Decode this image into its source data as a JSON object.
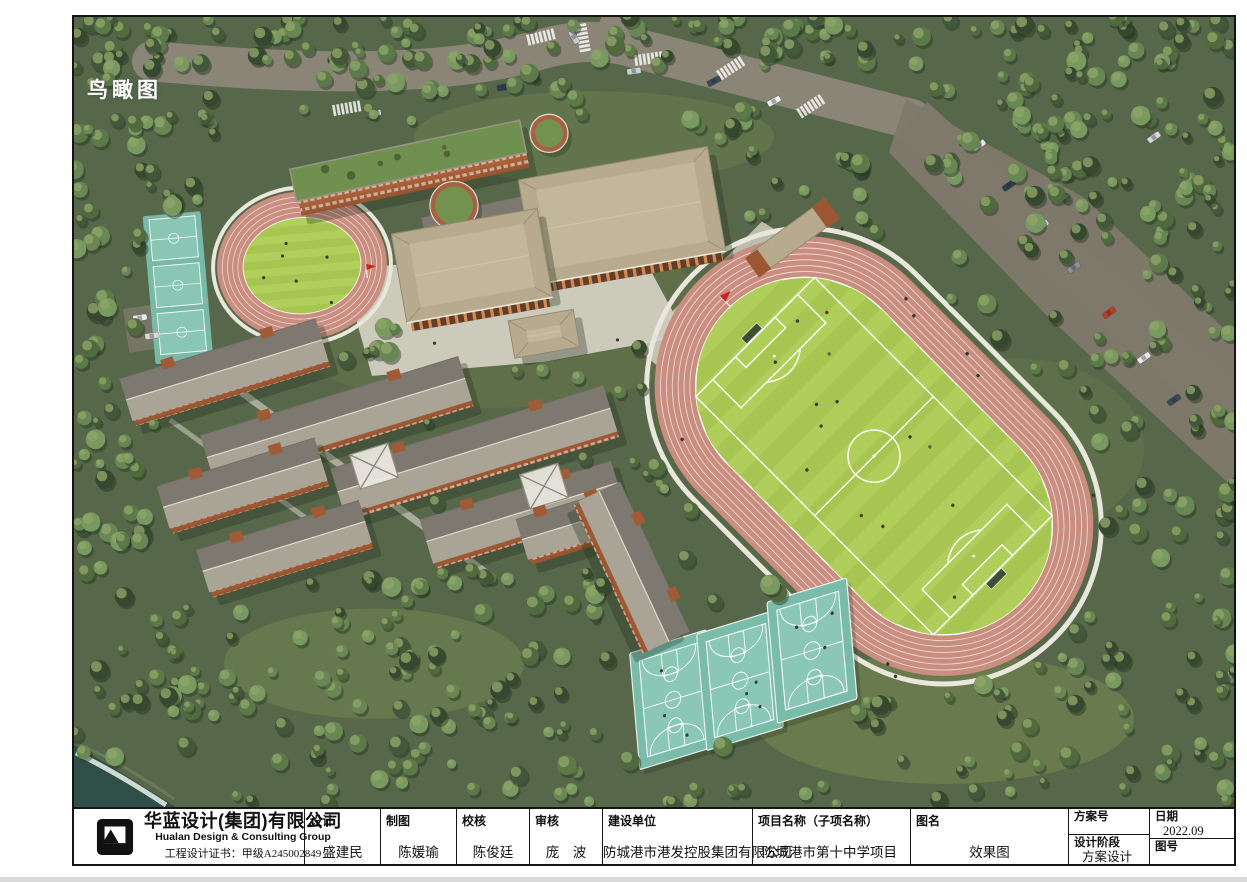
{
  "page": {
    "view_label": "鸟瞰图"
  },
  "rendering": {
    "colors": {
      "forest_base": "#57684a",
      "tree_shadow": "#243320",
      "tree_palette": [
        "#36482f",
        "#43573a",
        "#50693f",
        "#5c7a49",
        "#688754",
        "#789a60"
      ],
      "tree_highlight": "#8fa468",
      "road": "#8b8577",
      "parking": "#7f796c",
      "plaza": "#d8d4c8",
      "track_pink": "#ca8e81",
      "field_green": "#a6c551",
      "field_stripe": "#b2d05c",
      "court_teal": "#79bcaa",
      "court_teal_light": "#8ac7b5",
      "building_orange": "#b06340",
      "roof_tan": "#b7aa8e",
      "roof_gray_light": "#aaa497",
      "roof_gray_dark": "#7d7970",
      "roof_green": "#70904f",
      "water": "#2f4f48",
      "surf": "#e9f1ea",
      "flag_red": "#c6281e",
      "white_line": "#ffffff"
    }
  },
  "title_block": {
    "company": {
      "name_cn": "华蓝设计(集团)有限公司",
      "name_en": "Hualan Design & Consulting Group",
      "cert": "工程设计证书：甲级A245002849"
    },
    "fields": [
      {
        "label": "设计",
        "value": "盛建民"
      },
      {
        "label": "制图",
        "value": "陈媛瑜"
      },
      {
        "label": "校核",
        "value": "陈俊廷"
      },
      {
        "label": "审核",
        "value": "庞　波"
      },
      {
        "label": "建设单位",
        "value": "防城港市港发控股集团有限公司"
      },
      {
        "label": "项目名称（子项名称）",
        "value": "防城港市第十中学项目"
      },
      {
        "label": "图名",
        "value": "效果图"
      }
    ],
    "right": {
      "scheme_no_label": "方案号",
      "scheme_no_value": "",
      "stage_label": "设计阶段",
      "stage_value": "方案设计",
      "date_label": "日期",
      "date_value": "2022.09",
      "drawing_no_label": "图号",
      "drawing_no_value": ""
    }
  }
}
